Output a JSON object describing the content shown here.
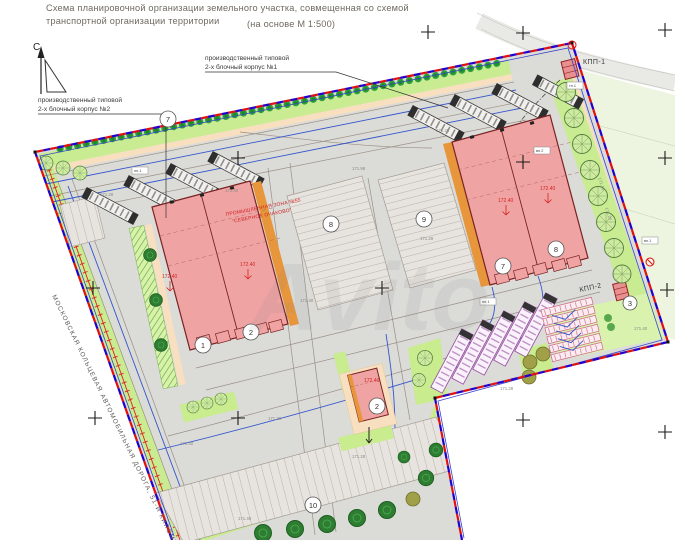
{
  "title": {
    "line1": "Схема планировочной организации земельного участка, совмещенная со схемой",
    "line2": "транспортной организации территории",
    "scale": "(на основе М 1:500)"
  },
  "north": {
    "label": "С"
  },
  "callouts": {
    "corpus1_l1": "производственный типовой",
    "corpus1_l2": "2-х блочный корпус №1",
    "corpus2_l1": "производственный типовой",
    "corpus2_l2": "2-х блочный корпус №2",
    "kpp1": "КПП-1",
    "kpp2": "КПП-2",
    "zone_l1": "ПРОМЫШЛЕННАЯ ЗОНА №55",
    "zone_l2": "\"СЕВЕРНОЕ ОЧАКОВО\"",
    "mkad": "МОСКОВСКАЯ КОЛЬЦЕВАЯ АВТОМОБИЛЬНАЯ ДОРОГА, 51-Й КИЛОМЕТР"
  },
  "plan_numbers": {
    "hedge": "7",
    "parking_a": "8",
    "parking_b": "9",
    "parking_south": "10",
    "left_block_a": "1",
    "left_block_b": "2",
    "right_block_a": "7",
    "right_block_b": "8",
    "aux_building": "2",
    "kpp2": "3"
  },
  "elevations": {
    "red": [
      "172.40",
      "172.40",
      "172.40",
      "172.40",
      "172.40"
    ],
    "gray": [
      "171.28",
      "171.40",
      "171.98",
      "171.28",
      "171.40",
      "171.28",
      "171.40",
      "171.28",
      "171.40",
      "171.28",
      "171.40",
      "171.28",
      "171.40",
      "171.28"
    ]
  },
  "tiny_labels": [
    "пл.1",
    "вл.2",
    "пл.1",
    "вл.1",
    "тп.1"
  ],
  "watermark": "Avito",
  "colors": {
    "boundary_blue": "#2200cc",
    "boundary_red": "#e01010",
    "building_pink": "#f0a3a3",
    "greenery": "#c9ec92",
    "orange": "#e8963c"
  }
}
